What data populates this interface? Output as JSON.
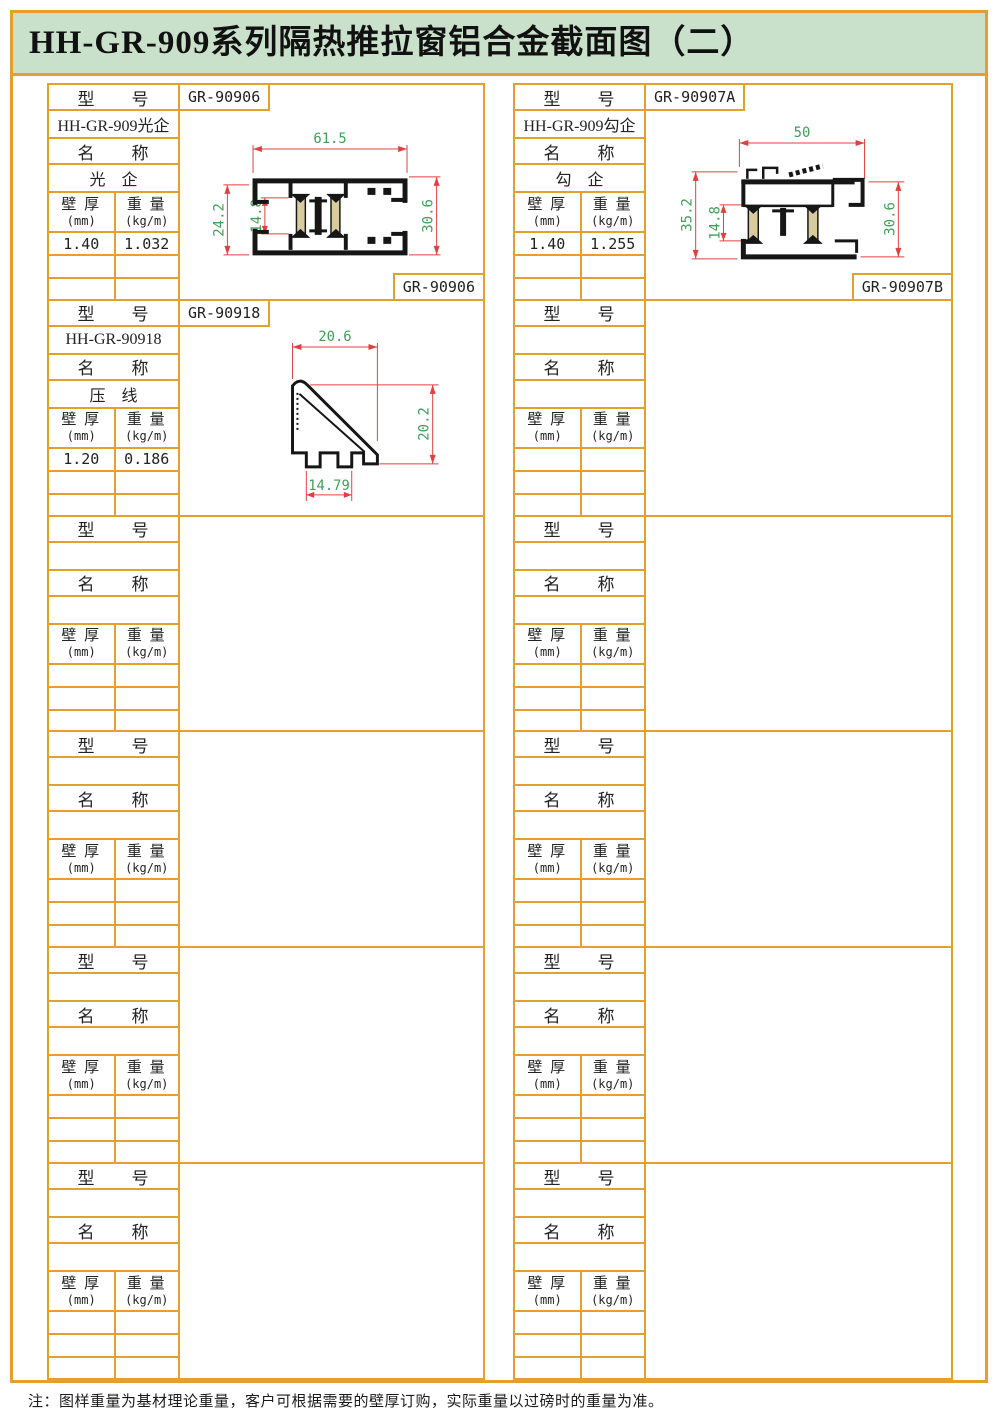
{
  "title": "HH-GR-909系列隔热推拉窗铝合金截面图（二）",
  "note": "注：图样重量为基材理论重量，客户可根据需要的壁厚订购，实际重量以过磅时的重量为准。",
  "colors": {
    "accent_orange": "#E3A02F",
    "title_green_bg": "#C9E0CA",
    "dimension_line_red": "#E04040",
    "dimension_text_green": "#3FA05A",
    "thermal_break_tan": "#D8CC9E"
  },
  "labels": {
    "model_header": "型　　号",
    "name_header": "名　　称",
    "thickness": "壁 厚",
    "thickness_unit": "(mm)",
    "weight": "重 量",
    "weight_unit": "(kg/m)"
  },
  "halves": [
    {
      "sections": [
        {
          "model_no": "GR-90906",
          "model_name": "HH-GR-909光企",
          "name_value": "光　企",
          "thickness_value": "1.40",
          "weight_value": "1.032",
          "bottom_no": "GR-90906",
          "drawing": "drawing-gr90906"
        },
        {
          "model_no": "GR-90918",
          "model_name": "HH-GR-90918",
          "name_value": "压　线",
          "thickness_value": "1.20",
          "weight_value": "0.186",
          "bottom_no": "",
          "drawing": "drawing-gr90918"
        },
        {},
        {},
        {},
        {}
      ]
    },
    {
      "sections": [
        {
          "model_no": "GR-90907A",
          "model_name": "HH-GR-909勾企",
          "name_value": "勾　企",
          "thickness_value": "1.40",
          "weight_value": "1.255",
          "bottom_no": "GR-90907B",
          "drawing": "drawing-gr90907"
        },
        {},
        {},
        {},
        {},
        {}
      ]
    }
  ],
  "drawings": {
    "gr90906": {
      "width": "61.5",
      "left_height": "24.2",
      "thermal_height": "14.8",
      "right_height": "30.6"
    },
    "gr90907": {
      "width": "50",
      "left_height": "35.2",
      "thermal_height": "14.8",
      "right_height": "30.6"
    },
    "gr90918": {
      "top_width": "20.6",
      "right_height": "20.2",
      "bottom_width": "14.79"
    }
  }
}
